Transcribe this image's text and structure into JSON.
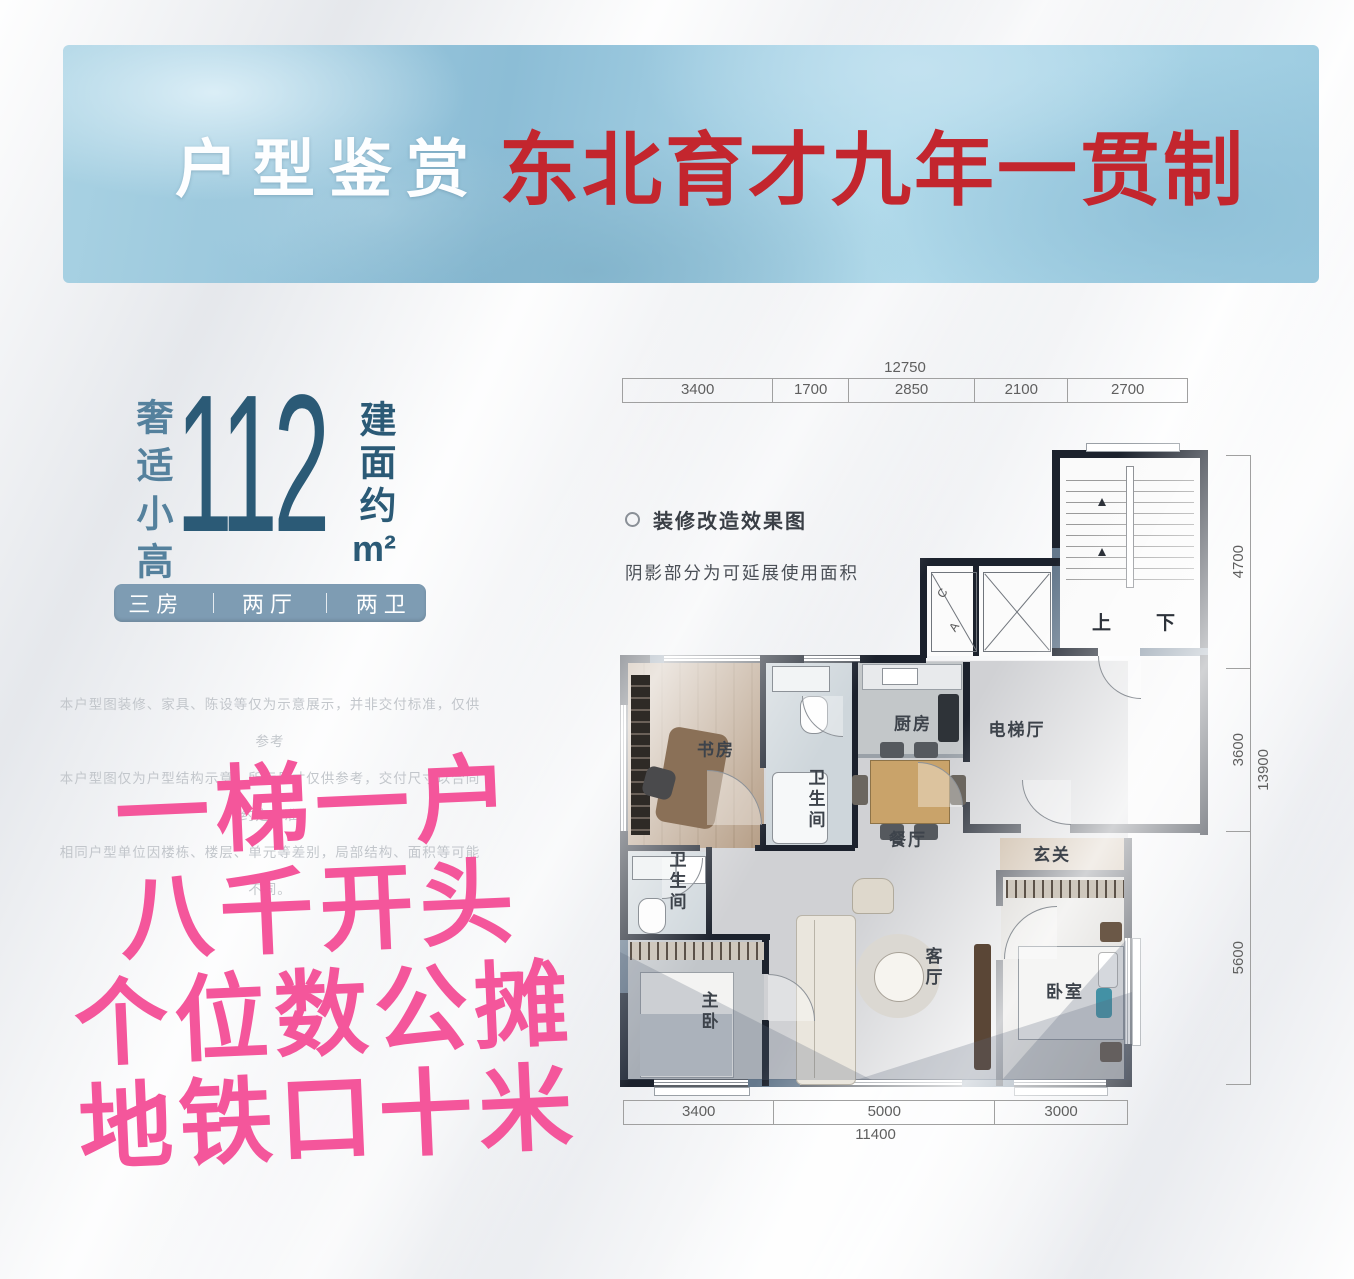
{
  "banner": {
    "title_white": "户型鉴赏",
    "title_red": "东北育才九年一贯制"
  },
  "left_panel": {
    "vertical_tagline": "奢适小高",
    "area_value": "112",
    "area_prefix": "建面约",
    "area_unit": "m²",
    "badge_items": [
      "三房",
      "两厅",
      "两卫"
    ]
  },
  "disclaimer_lines": [
    "本户型图装修、家具、陈设等仅为示意展示，并非交付标准，仅供参考",
    "本户型图仅为户型结构示意，所标尺寸仅供参考，交付尺寸以合同约定为准",
    "相同户型单位因楼栋、楼层、单元等差别，局部结构、面积等可能不同。"
  ],
  "slogan_lines": [
    "一梯一户",
    "八千开头",
    "个位数公摊",
    "地铁口十米"
  ],
  "floor_plan": {
    "legend_title": "装修改造效果图",
    "legend_note": "阴影部分为可延展使用面积",
    "stair_up": "上",
    "stair_down": "下",
    "shaft_labels": [
      "C",
      "A"
    ],
    "rooms": [
      {
        "key": "study",
        "label": "书房"
      },
      {
        "key": "bath1",
        "label": "卫生间"
      },
      {
        "key": "kitchen",
        "label": "厨房"
      },
      {
        "key": "dining",
        "label": "餐厅"
      },
      {
        "key": "elevator-hall",
        "label": "电梯厅"
      },
      {
        "key": "foyer",
        "label": "玄关"
      },
      {
        "key": "bath2",
        "label": "卫生间"
      },
      {
        "key": "master-bedroom",
        "label": "主卧"
      },
      {
        "key": "living-room",
        "label": "客厅"
      },
      {
        "key": "bedroom",
        "label": "卧室"
      }
    ],
    "dimensions": {
      "top": {
        "total": "12750",
        "segments": [
          {
            "label": "3400",
            "value": 3400
          },
          {
            "label": "1700",
            "value": 1700
          },
          {
            "label": "2850",
            "value": 2850
          },
          {
            "label": "2100",
            "value": 2100
          },
          {
            "label": "2700",
            "value": 2700
          }
        ]
      },
      "bottom": {
        "total": "11400",
        "segments": [
          {
            "label": "3400",
            "value": 3400
          },
          {
            "label": "5000",
            "value": 5000
          },
          {
            "label": "3000",
            "value": 3000
          }
        ]
      },
      "right": {
        "total": "13900",
        "segments": [
          {
            "label": "4700",
            "value": 4700
          },
          {
            "label": "3600",
            "value": 3600
          },
          {
            "label": "5600",
            "value": 5600
          }
        ]
      }
    }
  },
  "colors": {
    "banner_red": "#c3262e",
    "area_blue": "#2b5a76",
    "tagline_blue": "#55819d",
    "badge_bg": "#7e9cb3",
    "slogan_pink": "#f4569b",
    "wall_dark": "#1c222d",
    "wall_shaded_blue": "#64788c",
    "disclaimer_gray": "#c2c6cb"
  }
}
